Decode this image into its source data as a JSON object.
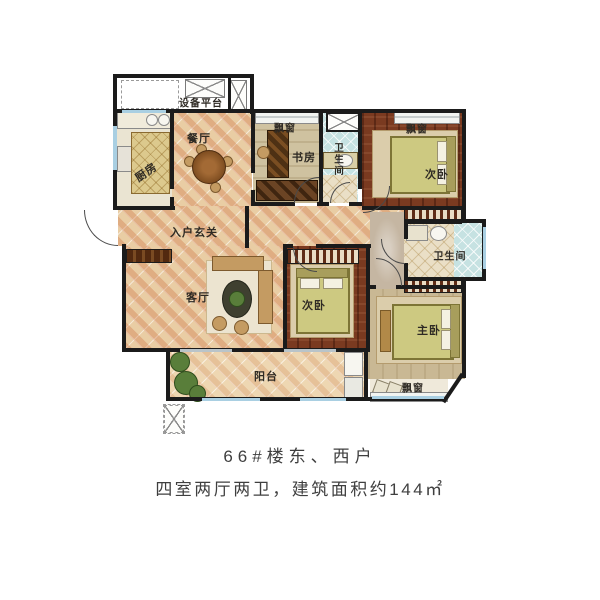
{
  "caption": {
    "line1": "66#楼东、西户",
    "line2": "四室两厅两卫，建筑面积约144㎡"
  },
  "floorplan": {
    "labels": {
      "equipment_platform": "设备平台",
      "dining": "餐厅",
      "kitchen": "厨房",
      "bay_window_study": "飘窗",
      "study": "书房",
      "bath_top": "卫生间",
      "bay_window_top_right": "飘窗",
      "bedroom_top_right": "次卧",
      "foyer": "入户玄关",
      "bath_right": "卫生间",
      "living": "客厅",
      "bedroom_middle": "次卧",
      "master": "主卧",
      "balcony": "阳台",
      "bay_window_bottom": "飘窗"
    },
    "colors": {
      "wall": "#1b1b1b",
      "tile_floor": "#e9cda4",
      "tile_stripe": "#cb6a3a",
      "dark_wood": "#7a3a20",
      "study_floor": "#cfc2a0",
      "master_floor": "#c9b894",
      "bath_tile": "#c6e2e2",
      "bed": "#cdc981",
      "window_glass": "#a9cfe2",
      "caption_text": "#3f3f3f"
    }
  }
}
